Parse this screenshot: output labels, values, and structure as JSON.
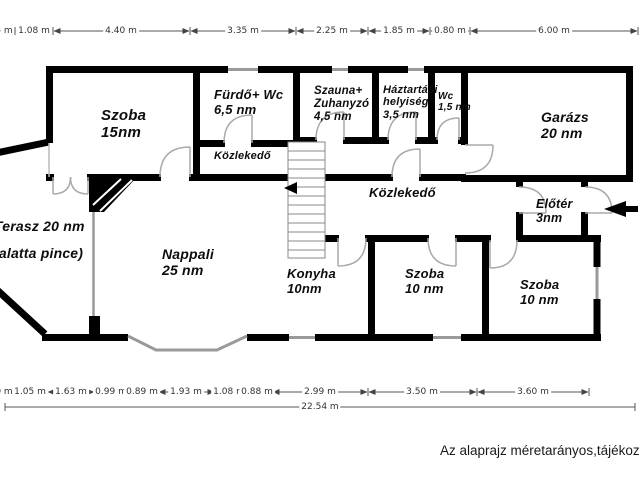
{
  "rooms": [
    {
      "lines": [
        "Szoba",
        "15nm"
      ]
    },
    {
      "lines": [
        "Fürdő+ Wc",
        "6,5 nm"
      ]
    },
    {
      "lines": [
        "Szauna+",
        "Zuhanyzó",
        "4,5 nm"
      ]
    },
    {
      "lines": [
        "Háztartási",
        "helyiség",
        "3,5 nm"
      ]
    },
    {
      "lines": [
        "Wc",
        "1,5 nm"
      ]
    },
    {
      "lines": [
        "Garázs",
        "20 nm"
      ]
    },
    {
      "lines": [
        "Közlekedő"
      ]
    },
    {
      "lines": [
        "Közlekedő"
      ]
    },
    {
      "lines": [
        "Előtér",
        "3nm"
      ]
    },
    {
      "lines": [
        "Terasz 20 nm",
        "(alatta pince)"
      ]
    },
    {
      "lines": [
        "Nappali",
        "25 nm"
      ]
    },
    {
      "lines": [
        "Konyha",
        "10nm"
      ]
    },
    {
      "lines": [
        "Szoba",
        "10 nm"
      ]
    },
    {
      "lines": [
        "Szoba",
        "10 nm"
      ]
    }
  ],
  "dims": {
    "top": [
      "5 m",
      "1.08 m",
      "4.40 m",
      "3.35 m",
      "2.25 m",
      "1.85 m",
      "0.80 m",
      "6.00 m"
    ],
    "bottom": [
      "0 m",
      "1.05 m",
      "1.63 m",
      "0.99 m",
      "0.89 m",
      "1.93 m",
      "1.08 m",
      "0.88 m",
      "2.99 m",
      "3.50 m",
      "3.60 m"
    ],
    "total": "22.54 m"
  },
  "footer": {
    "note": "Az alaprajz méretarányos,tájékoz"
  },
  "colors": {
    "wall": "#000000",
    "window": "#9a9a9a",
    "door": "#aaaaaa",
    "dim_line": "#555555"
  }
}
